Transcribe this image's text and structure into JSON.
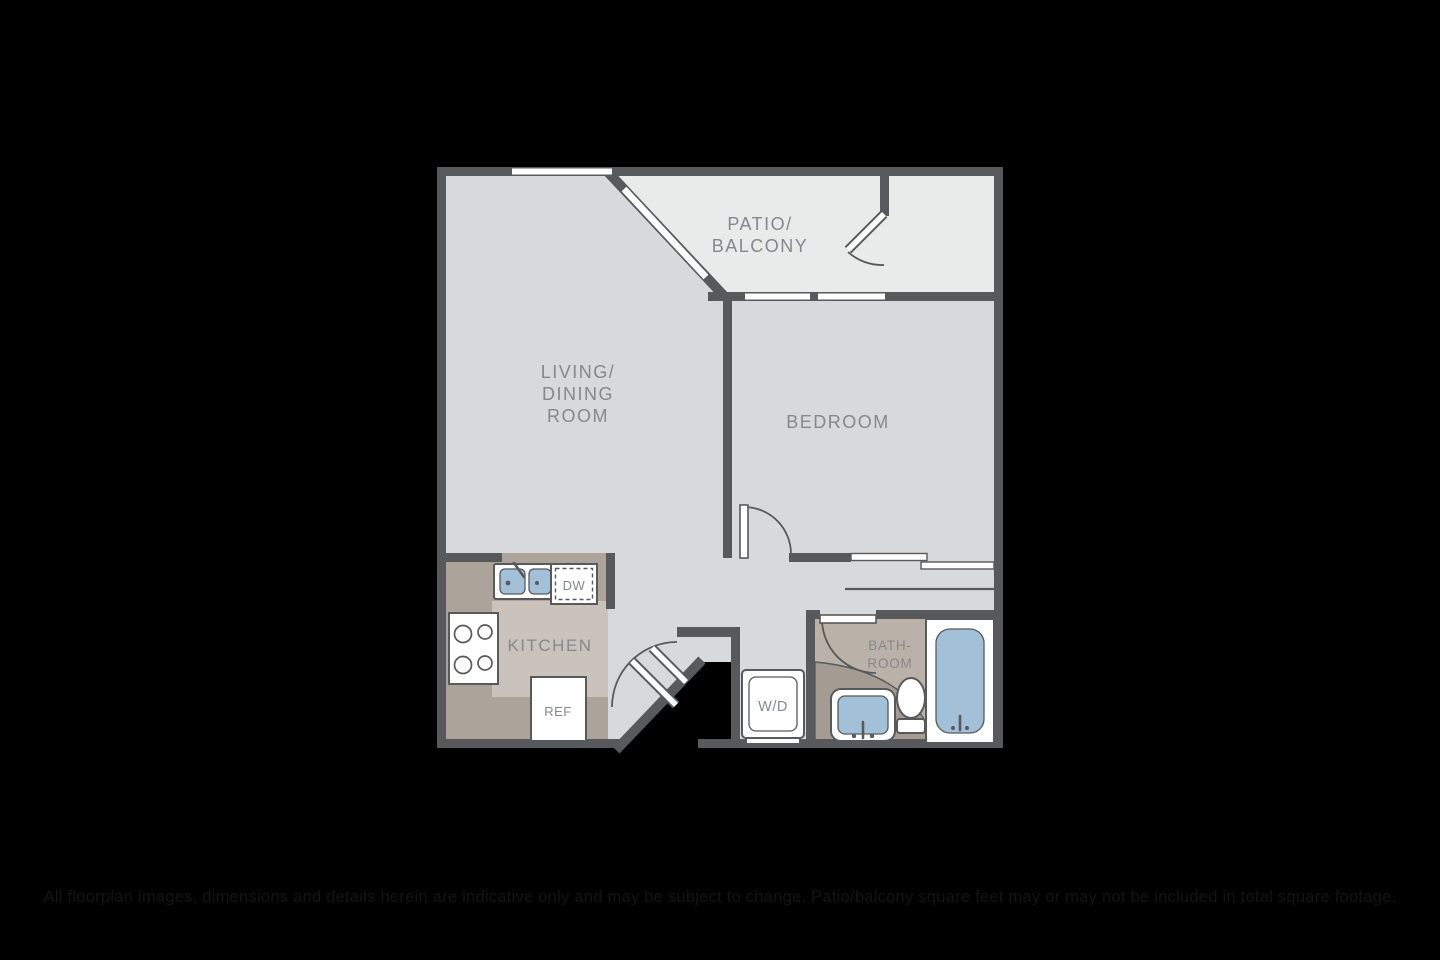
{
  "floorplan": {
    "rooms": {
      "patio": {
        "line1": "PATIO/",
        "line2": "BALCONY"
      },
      "living": {
        "line1": "LIVING/",
        "line2": "DINING",
        "line3": "ROOM"
      },
      "bedroom": {
        "label": "BEDROOM"
      },
      "kitchen": {
        "label": "KITCHEN"
      },
      "bathroom": {
        "line1": "BATH-",
        "line2": "ROOM"
      }
    },
    "appliances": {
      "dishwasher": "DW",
      "refrigerator": "REF",
      "washer_dryer": "W/D"
    },
    "colors": {
      "bg": "#000000",
      "wall": "#58595b",
      "floor_main": "#d8d9da",
      "floor_patio": "#e9eaea",
      "floor_kitchen": "#c9c3bb",
      "counter": "#aca49b",
      "floor_bath": "#bab2a9",
      "counter_bath": "#a49c93",
      "fixture_blue": "#a2c0d7",
      "label_text": "#85888c",
      "disclaimer_text": "#141414"
    }
  },
  "disclaimer": {
    "text": "All floorplan images, dimensions and details herein are indicative only and may be subject to change. Patio/balcony square feet may or may not be included in total square footage."
  }
}
